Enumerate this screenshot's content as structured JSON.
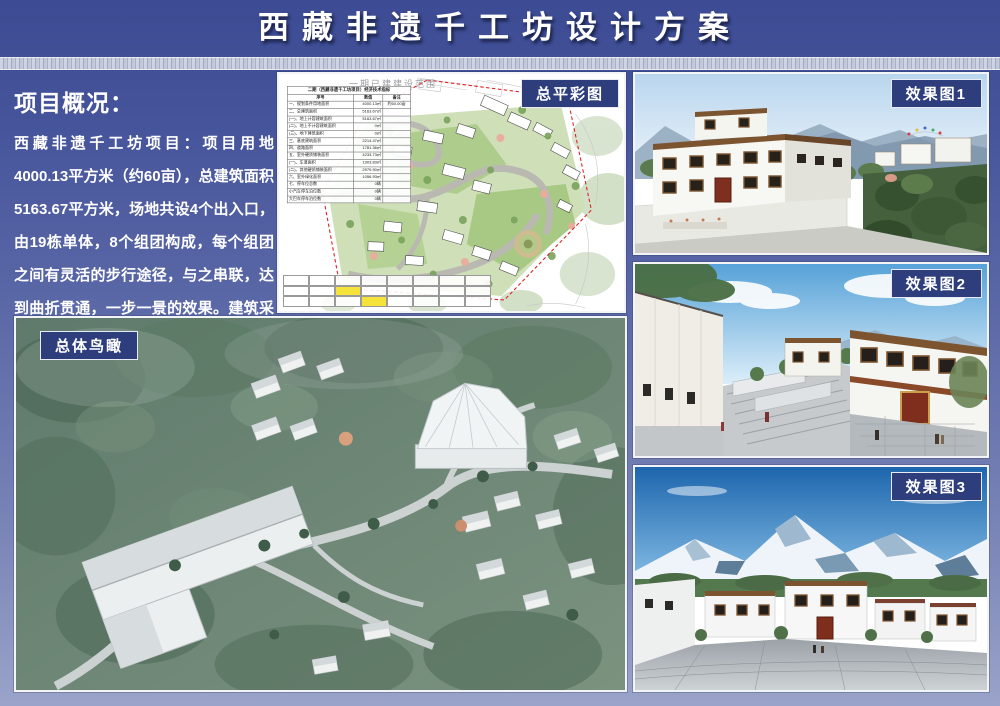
{
  "header": {
    "title": "西藏非遗千工坊设计方案"
  },
  "overview": {
    "heading": "项目概况：",
    "body": "西藏非遗千工坊项目：项目用地4000.13平方米（约60亩），总建筑面积5163.67平方米，场地共设4个出入口，由19栋单体，8个组团构成，每个组团之间有灵活的步行途径，与之串联，达到曲折贯通，一步一景的效果。建筑采用当地石材，整体色调为白色，门窗样式为藏式传统样式，有着浓厚的藏式风味，符合片区的整体风貌。"
  },
  "panels": {
    "siteplan": {
      "label": "总平彩图",
      "plan_title": "一期已建建设范围"
    },
    "render1": {
      "label": "效果图1"
    },
    "render2": {
      "label": "效果图2"
    },
    "render3": {
      "label": "效果图3"
    },
    "aerial": {
      "label": "总体鸟瞰"
    }
  },
  "siteplan_table": {
    "title": "二期（西藏非遗千工坊项目）经济技术指标",
    "columns": [
      "序号",
      "数值",
      "备注"
    ],
    "rows": [
      [
        "一、规划条件用地面积",
        "4000.13㎡",
        "约60.00亩"
      ],
      [
        "二、总建筑面积",
        "5163.67㎡",
        ""
      ],
      [
        "(一)、地上计容建筑面积",
        "5163.67㎡",
        ""
      ],
      [
        "(二)、地上不计容建筑面积",
        "0㎡",
        ""
      ],
      [
        "(三)、地下建筑面积",
        "0㎡",
        ""
      ],
      [
        "三、基底建筑面积",
        "2214.47㎡",
        ""
      ],
      [
        "四、道路面积",
        "1781.36㎡",
        ""
      ],
      [
        "五、室外硬质铺装面积",
        "4233.73㎡",
        ""
      ],
      [
        "(一)、车道面积",
        "1303.83㎡",
        ""
      ],
      [
        "(二)、其他硬质铺装面积",
        "2979.90㎡",
        ""
      ],
      [
        "六、室外绿化面积",
        "1056.93㎡",
        ""
      ],
      [
        "七、停车位总数",
        "0辆",
        ""
      ],
      [
        "小汽车停车泊位数",
        "0辆",
        ""
      ],
      [
        "大巴车停车泊位数",
        "0辆",
        ""
      ]
    ]
  },
  "colors": {
    "accent_navy": "#2e3e7d",
    "background_top": "#3c4b93",
    "background_bottom": "#9aa3c9",
    "boundary_red": "#dd2222",
    "table_highlight_yellow": "#f5e33a"
  }
}
